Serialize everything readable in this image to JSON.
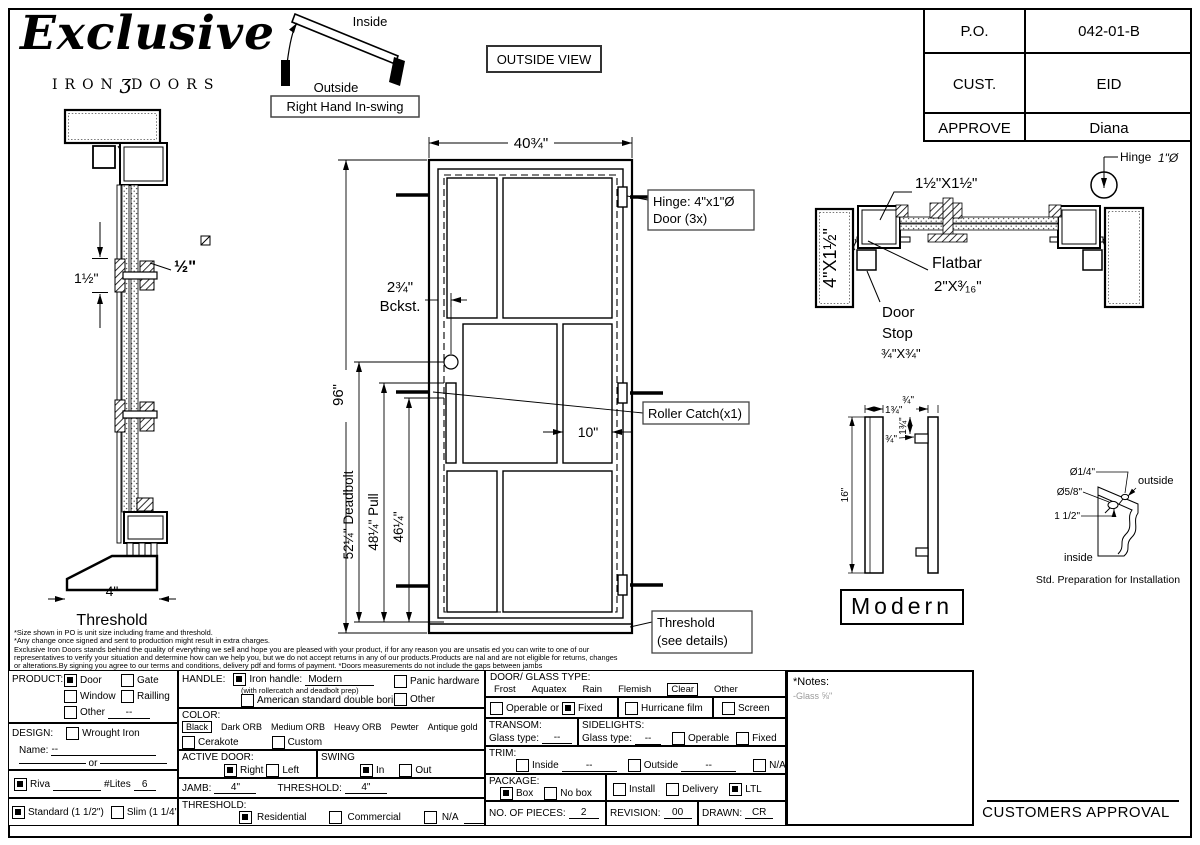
{
  "brand": {
    "script": "Exclusive",
    "sub_left": "IRON",
    "sub_glyph": "ʒ",
    "sub_right": "DOORS"
  },
  "title_block": {
    "rows": [
      {
        "label": "P.O.",
        "value": "042-01-B"
      },
      {
        "label": "CUST.",
        "value": "EID"
      },
      {
        "label": "APPROVE",
        "value": "Diana"
      }
    ]
  },
  "swing": {
    "inside": "Inside",
    "outside": "Outside",
    "caption": "Right Hand In-swing"
  },
  "outside_view": "OUTSIDE VIEW",
  "jamb_section": {
    "bar_height": "1½\"",
    "bar_size": "½\"",
    "threshold_dim": "4\"",
    "threshold_label": "Threshold"
  },
  "elevation": {
    "width": "40¾\"",
    "height": "96\"",
    "backset": "2¾\"",
    "backset_word": "Bckst.",
    "hinge_line1": "Hinge: 4\"x1\"Ø",
    "hinge_line2": "Door (3x)",
    "roller": "Roller Catch(x1)",
    "deadbolt": "52¼\" Deadbolt",
    "pull": "48¼\" Pull",
    "mid": "46¼\"",
    "panel": "10\"",
    "threshold1": "Threshold",
    "threshold2": "(see details)"
  },
  "head_section": {
    "jamb": "4\"X1½\"",
    "tube": "1½\"X1½\"",
    "flatbar1": "Flatbar",
    "flatbar2": "2\"X³⁄₁₆\"",
    "stop1": "Door",
    "stop2": "Stop",
    "stop3": "¾\"X¾\"",
    "hinge": "Hinge",
    "hinge_dia": "1\"Ø"
  },
  "handle_detail": {
    "w1": "1¾\"",
    "w2": "¾\"",
    "p1": "1¾\"",
    "p2": "¾\"",
    "len": "16\"",
    "name": "Modern"
  },
  "prep": {
    "d1": "Ø1/4\"",
    "d2": "Ø5/8\"",
    "off": "1 1/2\"",
    "outside": "outside",
    "inside": "inside",
    "caption": "Std. Preparation for Installation"
  },
  "disclaimer": [
    "*Size shown in PO is unit size including frame and threshold.",
    "*Any change once signed and sent to production might result in extra charges.",
    "Exclusive Iron Doors stands behind the quality of everything we sell and hope you are pleased with your product, if for any reason you are unsatis ed you can write to one of our",
    "representatives to verify your situation and determine how can we help you, but we do not accept returns in any of our products.Products are  nal and are not eligible for returns, changes",
    "or alterations.By signing you agree to our terms and conditions, delivery pdf and forms of payment. *Doors measurements do not include the gaps between jambs"
  ],
  "form": {
    "product": {
      "label": "PRODUCT:",
      "door": {
        "label": "Door",
        "checked": true
      },
      "gate": {
        "label": "Gate",
        "checked": false
      },
      "window": {
        "label": "Window",
        "checked": false
      },
      "railling": {
        "label": "Railling",
        "checked": false
      },
      "other": {
        "label": "Other",
        "checked": false,
        "value": "--"
      }
    },
    "design": {
      "label": "DESIGN:",
      "wrought": {
        "label": "Wrought Iron",
        "checked": false
      },
      "name_label": "Name:",
      "name_value": "--",
      "or": "or"
    },
    "riva": {
      "label": "Riva",
      "checked": true,
      "lites_label": "#Lites",
      "lites_value": "6"
    },
    "thickness": {
      "standard": {
        "label": "Standard (1 1/2\")",
        "checked": true
      },
      "slim": {
        "label": "Slim (1 1/4\")",
        "checked": false
      }
    },
    "handle": {
      "label": "HANDLE:",
      "iron": {
        "label": "Iron handle:",
        "value": "Modern",
        "checked": true
      },
      "subnote": "(with rollercatch and deadbolt prep)",
      "american": {
        "label": "American standard double boring",
        "checked": false
      },
      "panic": {
        "label": "Panic hardware",
        "checked": false
      },
      "other": {
        "label": "Other",
        "checked": false
      }
    },
    "color": {
      "label": "COLOR:",
      "selected": "Black",
      "opt1": "Dark ORB",
      "opt2": "Medium ORB",
      "opt3": "Heavy ORB",
      "opt4": "Pewter",
      "opt5": "Antique gold",
      "cerakote": {
        "label": "Cerakote",
        "checked": false
      },
      "custom": {
        "label": "Custom",
        "checked": false
      }
    },
    "active_door": {
      "label": "ACTIVE DOOR:",
      "right": {
        "label": "Right",
        "checked": true
      },
      "left": {
        "label": "Left",
        "checked": false
      }
    },
    "swing": {
      "label": "SWING",
      "in": {
        "label": "In",
        "checked": true
      },
      "out": {
        "label": "Out",
        "checked": false
      }
    },
    "jamb": {
      "label": "JAMB:",
      "value": "4\"",
      "threshold_label": "THRESHOLD:",
      "threshold_value": "4\""
    },
    "threshold": {
      "label": "THRESHOLD:",
      "residential": {
        "label": "Residential",
        "checked": true
      },
      "commercial": {
        "label": "Commercial",
        "checked": false
      },
      "na": {
        "label": "N/A",
        "checked": false
      }
    },
    "glass": {
      "label": "DOOR/ GLASS TYPE:",
      "opt1": "Frost",
      "opt2": "Aquatex",
      "opt3": "Rain",
      "opt4": "Flemish",
      "selected": "Clear",
      "opt6": "Other",
      "operable": {
        "label": "Operable",
        "checked": false
      },
      "or": "or",
      "fixed": {
        "label": "Fixed",
        "checked": true
      },
      "hurricane": {
        "label": "Hurricane film",
        "checked": false
      },
      "screen": {
        "label": "Screen",
        "checked": false
      }
    },
    "transom": {
      "label": "TRANSOM:",
      "glass_label": "Glass type:",
      "value": "--"
    },
    "sidelights": {
      "label": "SIDELIGHTS:",
      "glass_label": "Glass type:",
      "value": "--",
      "operable": {
        "label": "Operable",
        "checked": false
      },
      "fixed": {
        "label": "Fixed",
        "checked": false
      }
    },
    "trim": {
      "label": "TRIM:",
      "inside": {
        "label": "Inside",
        "checked": false,
        "value": "--"
      },
      "outside": {
        "label": "Outside",
        "checked": false,
        "value": "--"
      },
      "na": {
        "label": "N/A",
        "checked": false
      }
    },
    "package": {
      "label": "PACKAGE:",
      "box": {
        "label": "Box",
        "checked": true
      },
      "nobox": {
        "label": "No box",
        "checked": false
      },
      "install": {
        "label": "Install",
        "checked": false
      },
      "delivery": {
        "label": "Delivery",
        "checked": false
      },
      "ltl": {
        "label": "LTL",
        "checked": true
      }
    },
    "pieces": {
      "label": "NO. OF PIECES:",
      "value": "2"
    },
    "revision": {
      "label": "REVISION:",
      "value": "00"
    },
    "drawn": {
      "label": "DRAWN:",
      "value": "CR"
    },
    "notes": {
      "title": "*Notes:",
      "line1": "-Glass ⅝\""
    }
  },
  "approval": "CUSTOMERS APPROVAL"
}
